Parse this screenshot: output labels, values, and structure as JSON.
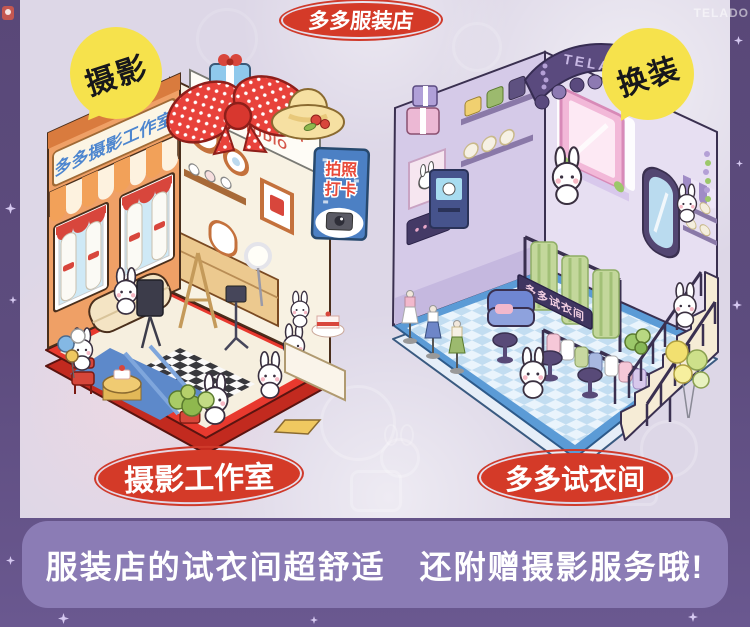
{
  "header": {
    "title_badge": "多多服装店",
    "left_badge": "摄影",
    "right_badge": "换装",
    "corner_brand": "TELADO"
  },
  "studio": {
    "caption": "摄影工作室",
    "facade_sign": "多多摄影工作室",
    "roof_sign_line1": "PHOTOGRAPH",
    "roof_sign_line2": "♥ STUDIO",
    "photo_sign_line1": "拍照",
    "photo_sign_line2": "打卡"
  },
  "store": {
    "caption": "多多试衣间",
    "awning_brand": "TELADO",
    "fitting_sign": "多多试衣间"
  },
  "banner": {
    "text": "服装店的试衣间超舒适　还附赠摄影服务哦!"
  },
  "colors": {
    "background_dark": "#5d4c7e",
    "panel_light": "#ddd7e7",
    "badge_red": "#d43a28",
    "badge_yellow": "#f6e24c",
    "banner_purple": "#8b7cb5",
    "studio_orange": "#efa066",
    "studio_base_red": "#e8392e",
    "store_awning_purple": "#5a4a7e",
    "store_base_blue": "#5b9bd6"
  }
}
